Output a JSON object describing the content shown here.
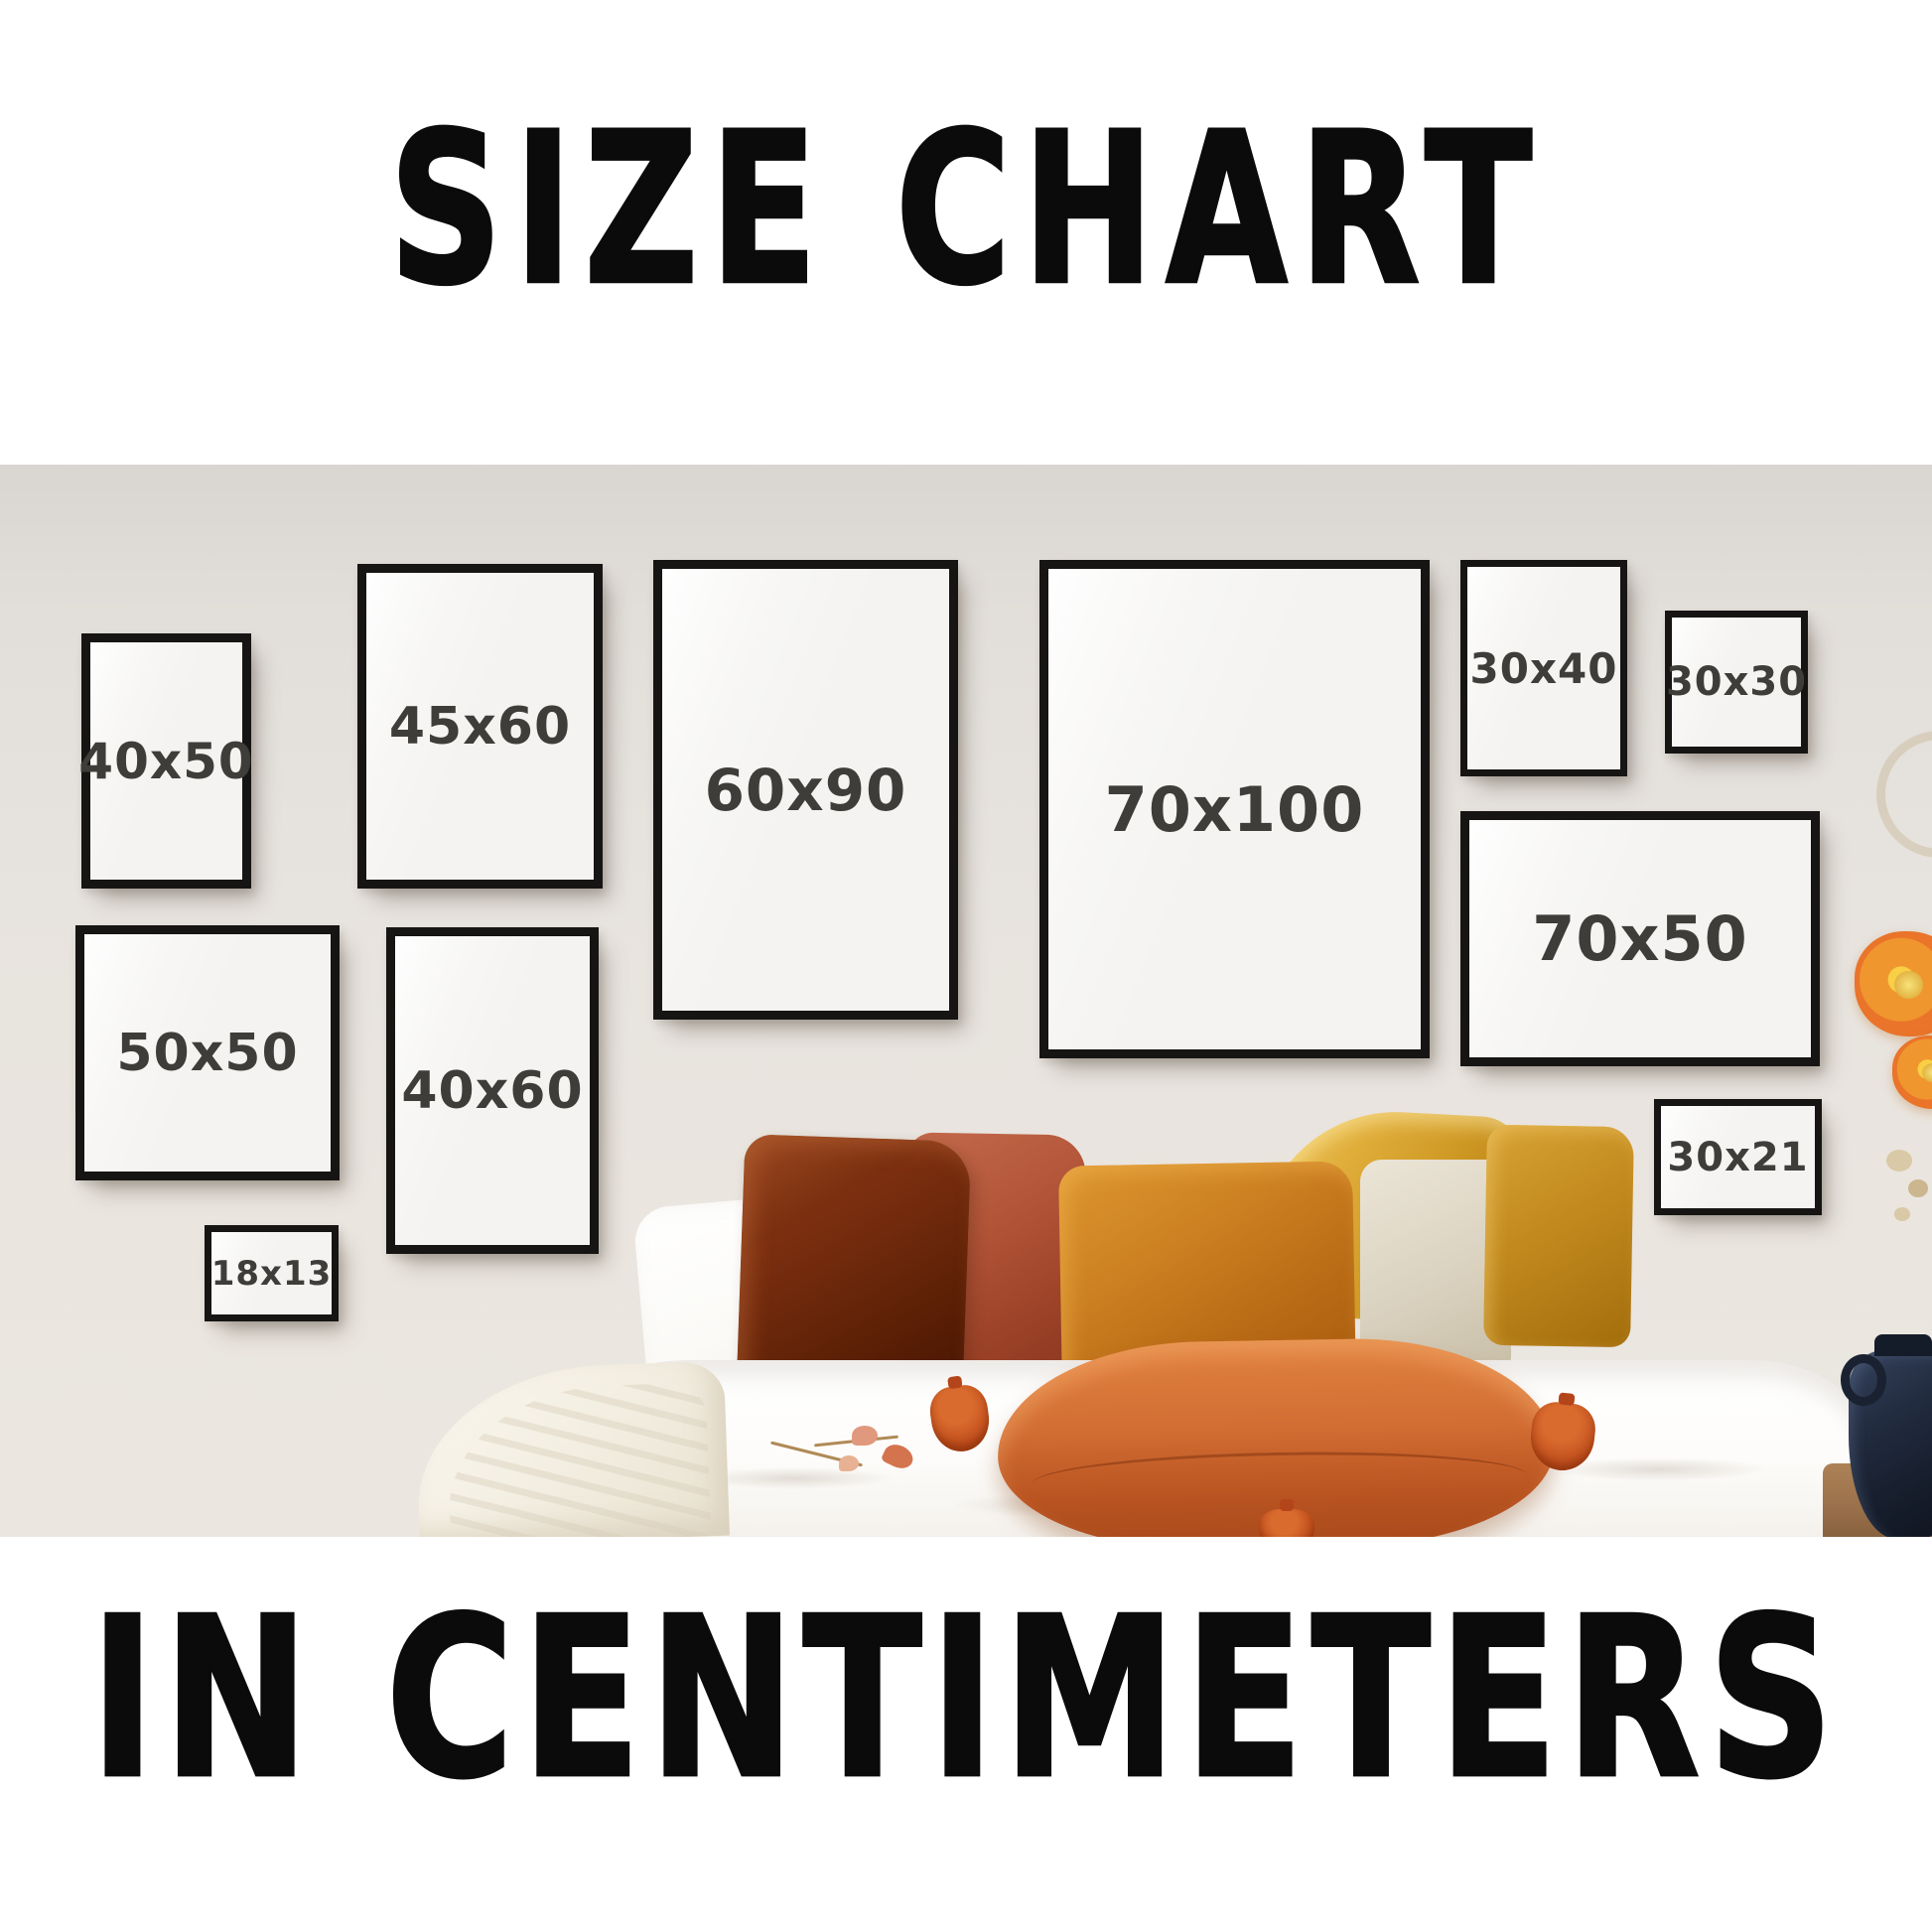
{
  "titles": {
    "top": "SIZE CHART",
    "bottom": "IN CENTIMETERS"
  },
  "frames": [
    {
      "label": "40x50"
    },
    {
      "label": "45x60"
    },
    {
      "label": "60x90"
    },
    {
      "label": "70x100"
    },
    {
      "label": "30x40"
    },
    {
      "label": "30x30"
    },
    {
      "label": "70x50"
    },
    {
      "label": "50x50"
    },
    {
      "label": "40x60"
    },
    {
      "label": "18x13"
    },
    {
      "label": "30x21"
    }
  ],
  "units": "centimeters",
  "colors": {
    "title_text": "#0b0b0b",
    "frame_border": "#161514",
    "frame_face": "#f4f3f1",
    "label_text": "#3e3d3a",
    "wall": "#e7e3de",
    "bed_white": "#fdfcfa",
    "blanket": "#f4efe4",
    "pillow_dark_rust": "#72290d",
    "pillow_terracotta": "#b25438",
    "pillow_amber": "#c87c1f",
    "pillow_gold_satin": "#d9a62f",
    "pillow_cream": "#d9d2c0",
    "pillow_mustard": "#c28a1e",
    "front_pillow": "#cf6a31",
    "tassel": "#bf4d1c",
    "vase": "#1d2532",
    "flower": "#ec7f27"
  }
}
